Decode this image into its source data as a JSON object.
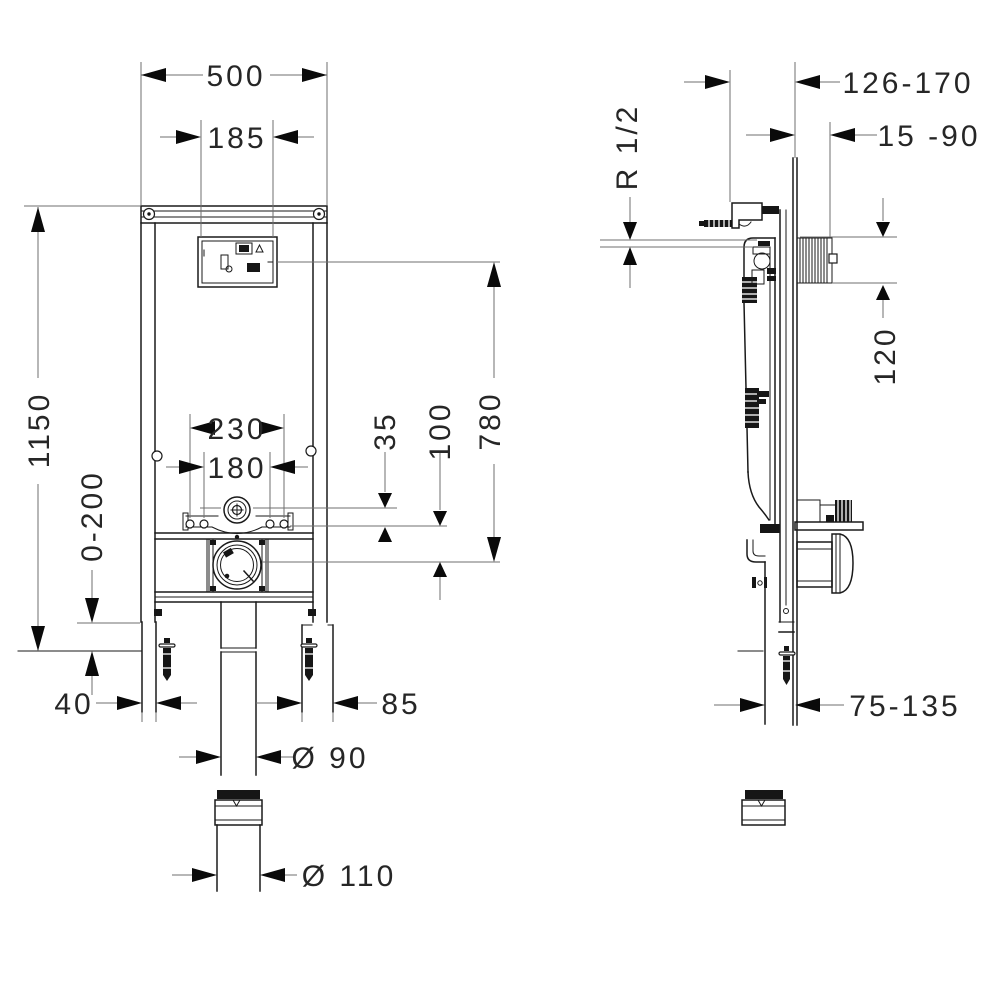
{
  "drawing_type": "installation frame technical drawing, front and side view",
  "front_view": {
    "dims": {
      "overall_width": "500",
      "opening_width": "185",
      "overall_height": "1150",
      "leg_adjustment": "0-200",
      "fixing_spacing_outer": "230",
      "fixing_spacing_inner": "180",
      "flush_pipe_offset": "35",
      "outlet_offset": "100",
      "opening_to_outlet": "780",
      "foot_width": "40",
      "foot_plate_width": "85",
      "outlet_diameter": "Ø 90",
      "connector_diameter": "Ø 110"
    }
  },
  "side_view": {
    "dims": {
      "frame_depth": "126-170",
      "wall_finish_depth": "15 -90",
      "water_connection": "R 1/2",
      "opening_height": "120",
      "outlet_depth": "75-135"
    }
  },
  "colors": {
    "line": "#1a1a1a",
    "dimension_line": "#6f6f6f",
    "solid_fill": "#161616",
    "background": "#ffffff"
  }
}
